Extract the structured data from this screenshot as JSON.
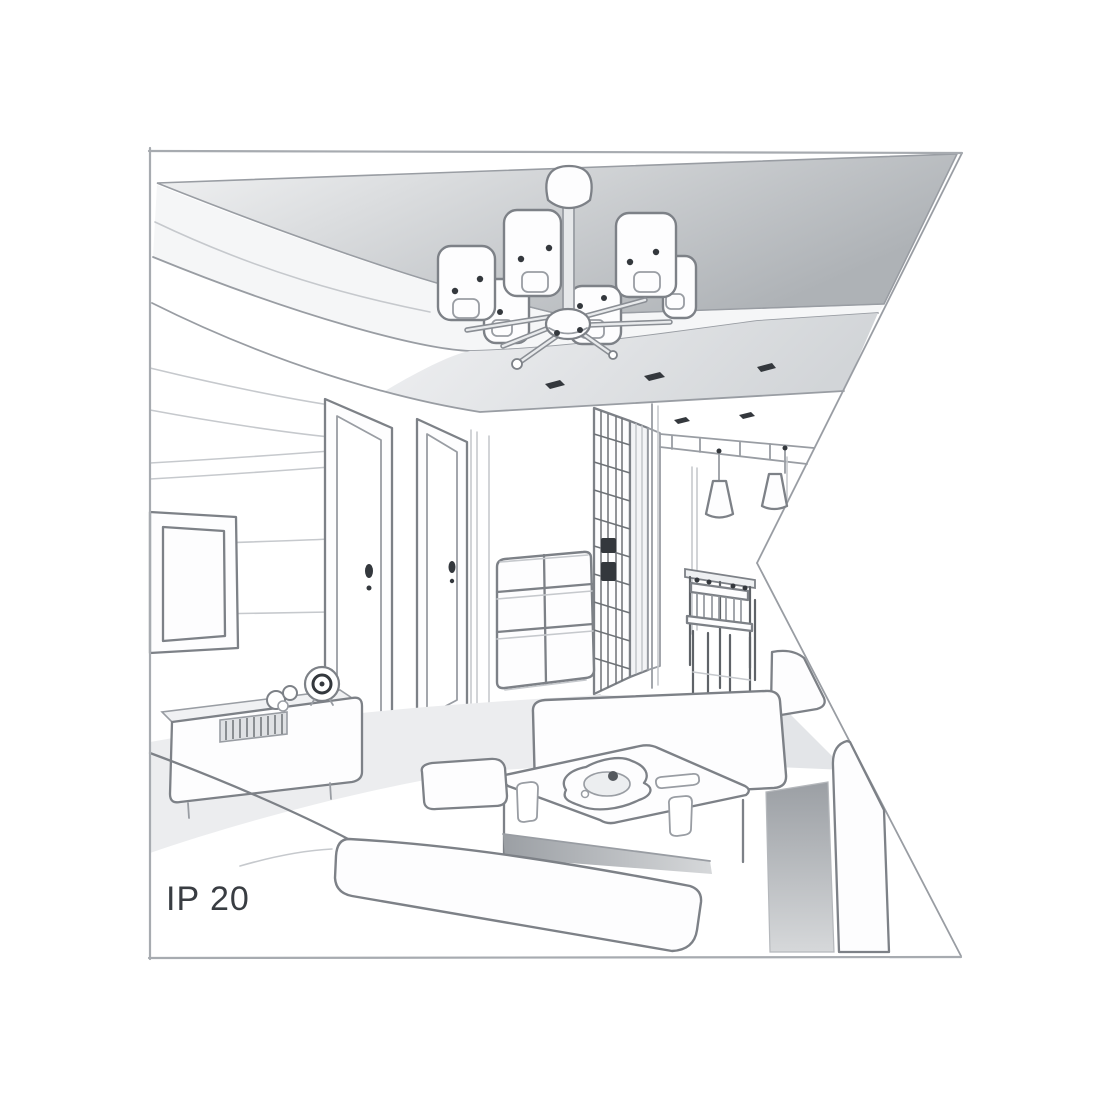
{
  "illustration": {
    "name": "living-room-perspective-sketch",
    "depicts": "grayscale line-art interior viewed in one-point perspective: ceiling chandelier with six cylindrical shades on radial arms, recessed ceiling with spotlights, paneled TV wall with sideboard and clock, two interior doors, chest of drawers, lattice wardrobe, hallway dining nook with two cone pendant lamps, table and chairs, sofas and a coffee table with tray",
    "objects": [
      "chandelier",
      "ceiling-spotlights",
      "tv-frame",
      "tv-cabinet",
      "clock",
      "soundbar",
      "door",
      "door",
      "chest-of-drawers",
      "wardrobe",
      "pendant-lamps",
      "dining-table",
      "dining-chairs",
      "sofa",
      "coffee-table",
      "tray",
      "cups"
    ]
  },
  "label": {
    "ip_rating": "IP 20"
  },
  "colors": {
    "background": "#ffffff",
    "frame_line": "#a7abb0",
    "line_main": "#7d8187",
    "line_mid": "#999da3",
    "line_light": "#c6c9cd",
    "detail_dark": "#34383d",
    "ceiling_light": "#f2f3f4",
    "ceiling_dark": "#aeb2b6",
    "band_light": "#eff0f2",
    "band_dark": "#d2d5d8",
    "step_face": "#f5f6f7",
    "shadow_dark": "#9b9fa4",
    "shadow_light": "#d6d8da",
    "floor_light": "#ecedef",
    "floor_mid": "#e3e5e8",
    "text": "#393d42"
  }
}
